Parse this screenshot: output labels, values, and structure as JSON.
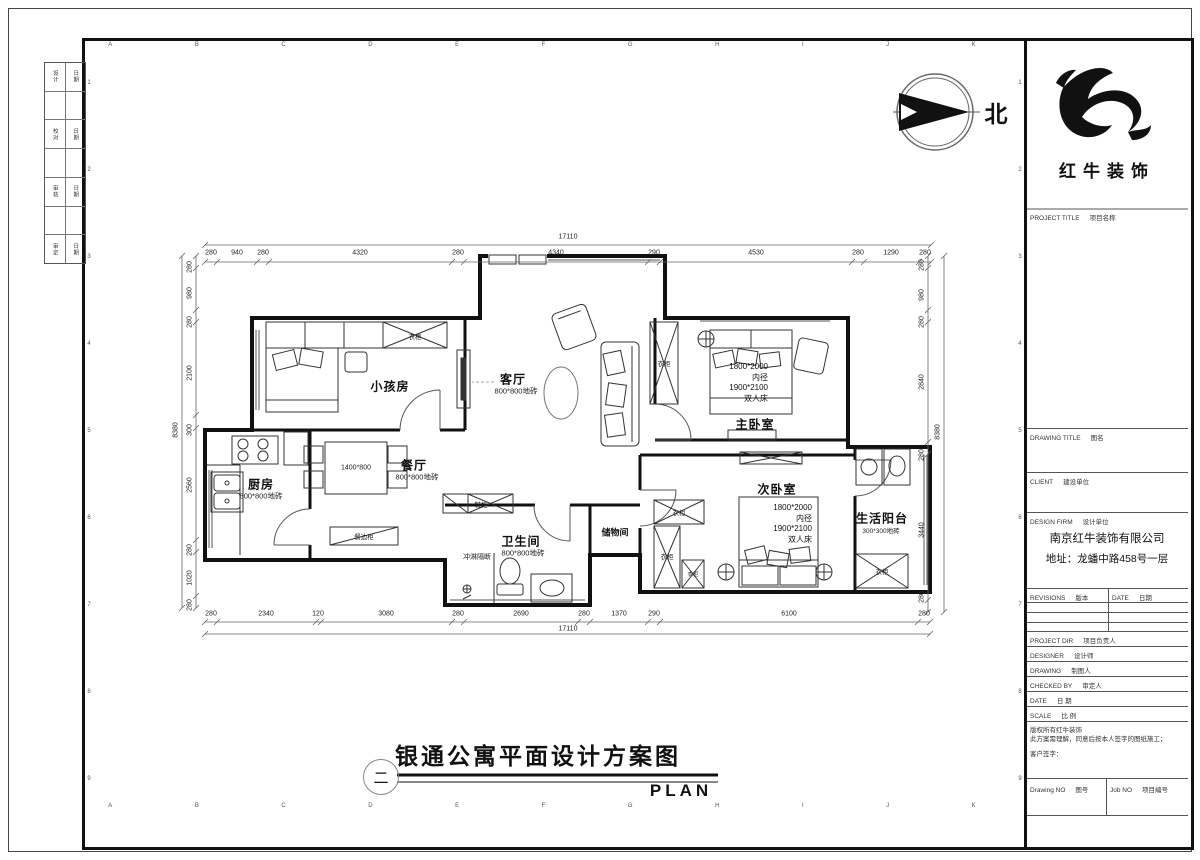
{
  "sheet": {
    "north_label": "北",
    "grid_letters": [
      "A",
      "B",
      "C",
      "D",
      "E",
      "F",
      "G",
      "H",
      "I",
      "J",
      "K"
    ],
    "grid_numbers": [
      "1",
      "2",
      "3",
      "4",
      "5",
      "6",
      "7",
      "8",
      "9"
    ]
  },
  "margin_stamp": {
    "rows": [
      {
        "left": "设计",
        "right": "日期"
      },
      {
        "left": "校对",
        "right": "日期"
      },
      {
        "left": "审核",
        "right": "日期"
      },
      {
        "left": "审定",
        "right": "日期"
      }
    ]
  },
  "title_block": {
    "logo_name": "红牛装饰",
    "project_title_en": "PROJECT TITLE",
    "project_title_cn": "项目名称",
    "drawing_title_en": "DRAWING TITLE",
    "drawing_title_cn": "图名",
    "client_en": "CLIENT",
    "client_cn": "建设单位",
    "design_firm_en": "DESIGN FIRM",
    "design_firm_cn": "设计单位",
    "firm_name": "南京红牛装饰有限公司",
    "firm_address": "地址：龙蟠中路458号一层",
    "revisions_en": "REVISIONS",
    "revisions_cn": "版本",
    "date_col_en": "DATE",
    "date_col_cn": "日期",
    "rows": [
      {
        "en": "PROJECT DIR",
        "cn": "项目负责人"
      },
      {
        "en": "DESIGNER",
        "cn": "设计师"
      },
      {
        "en": "DRAWING",
        "cn": "制图人"
      },
      {
        "en": "CHECKED BY",
        "cn": "审定人"
      },
      {
        "en": "DATE",
        "cn": "日 期"
      },
      {
        "en": "SCALE",
        "cn": "比 例"
      }
    ],
    "disclaimer_line1": "版权所有红牛装饰",
    "disclaimer_line2": "此方案需理解，同意后按本人签字的图纸施工；",
    "customer_sign": "客户签字：",
    "drawing_no_en": "Drawing NO",
    "drawing_no_cn": "图号",
    "job_no_en": "Job NO",
    "job_no_cn": "项目编号"
  },
  "titlebar": {
    "number": "二",
    "title": "银通公寓平面设计方案图",
    "subtitle": "PLAN"
  },
  "plan": {
    "rooms": {
      "kids": {
        "name": "小孩房"
      },
      "living": {
        "name": "客厅",
        "note": "800*800地砖"
      },
      "dining": {
        "name": "餐厅",
        "note": "800*800地砖"
      },
      "kitchen": {
        "name": "厨房",
        "note": "800*800地砖"
      },
      "bath": {
        "name": "卫生间",
        "note": "800*800地砖"
      },
      "master": {
        "name": "主卧室",
        "bed_l1": "1800*2000",
        "bed_l2": "内径",
        "bed_l3": "1900*2100",
        "bed_l4": "双人床"
      },
      "second": {
        "name": "次卧室",
        "bed_l1": "1800*2000",
        "bed_l2": "内径",
        "bed_l3": "1900*2100",
        "bed_l4": "双人床"
      },
      "balcony": {
        "name": "生活阳台",
        "note": "300*300地砖"
      },
      "storage": {
        "name": "储物间"
      },
      "shower": {
        "name": "冲淋隔断"
      }
    },
    "cabinets": {
      "wardrobe": "衣柜",
      "sideboard": "餐边柜",
      "shoe": "鞋柜",
      "table_size": "1400*800"
    },
    "dims": {
      "top_total": "17110",
      "top": [
        "280",
        "940",
        "280",
        "4320",
        "280",
        "4340",
        "290",
        "4530",
        "280",
        "1290",
        "280"
      ],
      "bottom_total": "17110",
      "bottom": [
        "280",
        "2340",
        "120",
        "3080",
        "280",
        "2690",
        "280",
        "1370",
        "290",
        "6100",
        "280"
      ],
      "left_total": "8380",
      "left": [
        "280",
        "980",
        "280",
        "2100",
        "300",
        "2560",
        "280",
        "1020",
        "280"
      ],
      "right_total": "8380",
      "right": [
        "280",
        "980",
        "280",
        "2840",
        "280",
        "3440",
        "280"
      ]
    }
  }
}
